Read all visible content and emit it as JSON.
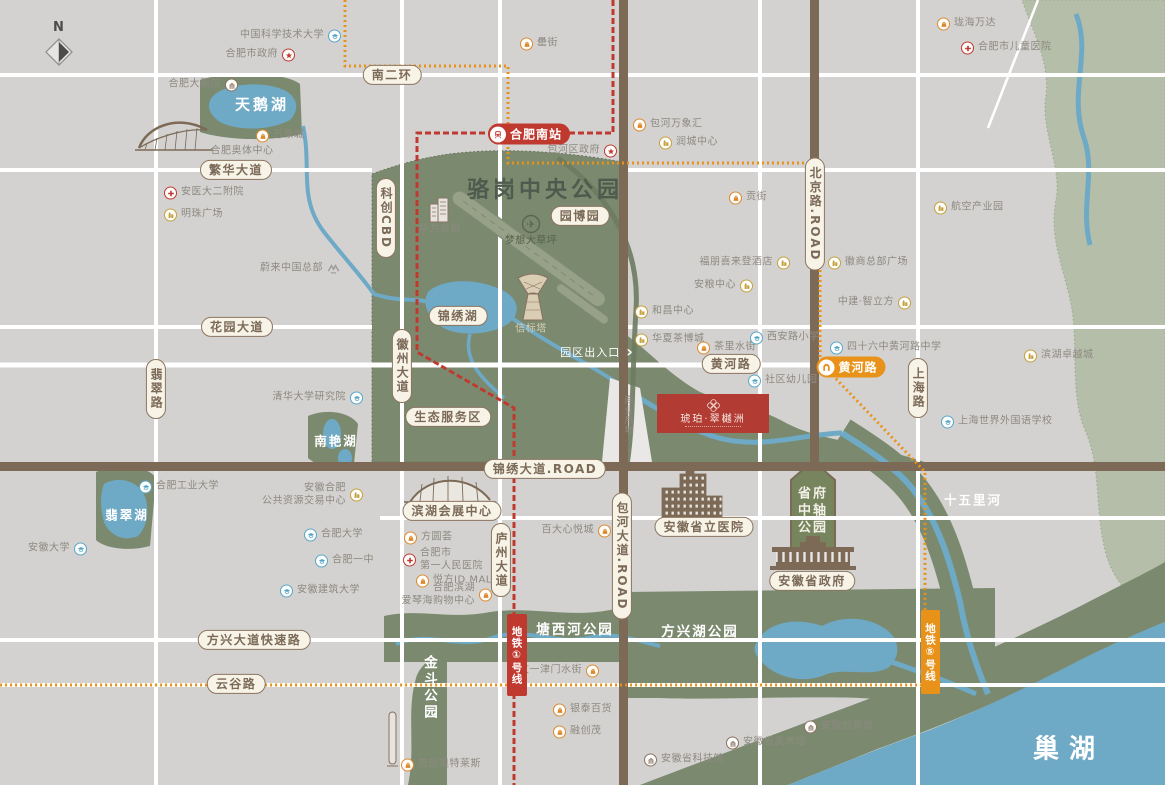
{
  "compass": {
    "label": "N"
  },
  "titles": {
    "park": "骆岗中央公园"
  },
  "project": {
    "name": "琥珀·翠樾洲"
  },
  "stations": {
    "hefei_south": "合肥南站",
    "huanghe_road": "黄河路"
  },
  "metro": {
    "line1": "地铁①号线",
    "line5": "地铁⑤号线"
  },
  "park_features": {
    "entrance": "园区出入口",
    "entrance_arrow": "›",
    "commercial": "商业用地",
    "axis_park": "省府\n中轴\n公园"
  },
  "road_labels": [
    {
      "t": "南二环",
      "x": 392,
      "y": 75
    },
    {
      "t": "繁华大道",
      "x": 236,
      "y": 170
    },
    {
      "t": "花园大道",
      "x": 237,
      "y": 327
    },
    {
      "t": "翡翠路",
      "x": 156,
      "y": 389,
      "v": true
    },
    {
      "t": "科创CBD",
      "x": 386,
      "y": 218,
      "v": true
    },
    {
      "t": "锦绣湖",
      "x": 458,
      "y": 316
    },
    {
      "t": "园博园",
      "x": 580,
      "y": 216
    },
    {
      "t": "徽州大道",
      "x": 402,
      "y": 366,
      "v": true
    },
    {
      "t": "黄河路",
      "x": 731,
      "y": 364
    },
    {
      "t": "生态服务区",
      "x": 448,
      "y": 417
    },
    {
      "t": "锦绣大道.ROAD",
      "x": 545,
      "y": 469
    },
    {
      "t": "滨湖会展中心",
      "x": 452,
      "y": 511
    },
    {
      "t": "庐州大道",
      "x": 501,
      "y": 560,
      "v": true
    },
    {
      "t": "包河大道.ROAD",
      "x": 622,
      "y": 556,
      "v": true
    },
    {
      "t": "北京路.ROAD",
      "x": 815,
      "y": 214,
      "v": true
    },
    {
      "t": "安徽省立医院",
      "x": 704,
      "y": 527
    },
    {
      "t": "安徽省政府",
      "x": 812,
      "y": 581
    },
    {
      "t": "上海路",
      "x": 918,
      "y": 388,
      "v": true
    },
    {
      "t": "方兴大道快速路",
      "x": 254,
      "y": 640
    },
    {
      "t": "云谷路",
      "x": 236,
      "y": 684
    }
  ],
  "area_labels": [
    {
      "t": "天鹅湖",
      "x": 262,
      "y": 104,
      "cls": "lake-lg"
    },
    {
      "t": "南艳湖",
      "x": 336,
      "y": 440,
      "cls": "lake"
    },
    {
      "t": "翡翠湖",
      "x": 127,
      "y": 514,
      "cls": "lake"
    },
    {
      "t": "十五里河",
      "x": 973,
      "y": 499,
      "cls": "lake"
    },
    {
      "t": "巢湖",
      "x": 1069,
      "y": 747,
      "cls": "lake-xl"
    },
    {
      "t": "塘西河公园",
      "x": 575,
      "y": 628,
      "cls": "parkband"
    },
    {
      "t": "方兴湖公园",
      "x": 700,
      "y": 630,
      "cls": "parkband"
    },
    {
      "t": "金斗公园",
      "x": 429,
      "y": 688,
      "cls": "parkband v"
    }
  ],
  "landmark_labels": [
    {
      "t": "合肥奥体中心",
      "x": 242,
      "y": 149,
      "cls": ""
    },
    {
      "t": "华为总部",
      "x": 440,
      "y": 227,
      "cls": ""
    },
    {
      "t": "梦想大草坪",
      "x": 531,
      "y": 239,
      "cls": "dark"
    },
    {
      "t": "信标塔",
      "x": 531,
      "y": 327,
      "cls": "beige"
    }
  ],
  "pois": [
    {
      "t": "中国科学技术大学",
      "x": 333,
      "y": 36,
      "icon": "school",
      "side": "left"
    },
    {
      "t": "合肥市政府",
      "x": 287,
      "y": 55,
      "icon": "gov",
      "side": "left"
    },
    {
      "t": "合肥大剧院",
      "x": 230,
      "y": 85,
      "icon": "culture",
      "side": "left"
    },
    {
      "t": "万象城",
      "x": 264,
      "y": 136,
      "icon": "mall",
      "side": "right"
    },
    {
      "t": "安医大二附院",
      "x": 172,
      "y": 193,
      "icon": "hospital",
      "side": "right"
    },
    {
      "t": "明珠广场",
      "x": 172,
      "y": 215,
      "icon": "building",
      "side": "right"
    },
    {
      "t": "罍街",
      "x": 528,
      "y": 44,
      "icon": "mall",
      "side": "right"
    },
    {
      "t": "包河万象汇",
      "x": 641,
      "y": 125,
      "icon": "mall",
      "side": "right"
    },
    {
      "t": "润城中心",
      "x": 667,
      "y": 143,
      "icon": "building",
      "side": "right"
    },
    {
      "t": "包河区政府",
      "x": 609,
      "y": 151,
      "icon": "gov",
      "side": "left"
    },
    {
      "t": "珑海万达",
      "x": 945,
      "y": 24,
      "icon": "mall",
      "side": "right"
    },
    {
      "t": "合肥市儿童医院",
      "x": 969,
      "y": 48,
      "icon": "hospital",
      "side": "right"
    },
    {
      "t": "贡街",
      "x": 737,
      "y": 198,
      "icon": "mall",
      "side": "right"
    },
    {
      "t": "航空产业园",
      "x": 942,
      "y": 208,
      "icon": "building",
      "side": "right"
    },
    {
      "t": "福朋喜来登酒店",
      "x": 782,
      "y": 263,
      "icon": "building",
      "side": "left"
    },
    {
      "t": "徽商总部广场",
      "x": 836,
      "y": 263,
      "icon": "building",
      "side": "right"
    },
    {
      "t": "安粮中心",
      "x": 745,
      "y": 286,
      "icon": "building",
      "side": "left"
    },
    {
      "t": "和昌中心",
      "x": 643,
      "y": 312,
      "icon": "building",
      "side": "right"
    },
    {
      "t": "中建·智立方",
      "x": 903,
      "y": 303,
      "icon": "building",
      "side": "left"
    },
    {
      "t": "华夏茶博城",
      "x": 643,
      "y": 340,
      "icon": "building",
      "side": "right"
    },
    {
      "t": "茶里水街",
      "x": 705,
      "y": 348,
      "icon": "mall",
      "side": "right"
    },
    {
      "t": "西安路小学",
      "x": 758,
      "y": 338,
      "icon": "school",
      "side": "right"
    },
    {
      "t": "四十六中黄河路中学",
      "x": 838,
      "y": 348,
      "icon": "school",
      "side": "right"
    },
    {
      "t": "社区幼儿园",
      "x": 756,
      "y": 381,
      "icon": "school",
      "side": "right"
    },
    {
      "t": "滨湖卓越城",
      "x": 1032,
      "y": 356,
      "icon": "building",
      "side": "right"
    },
    {
      "t": "上海世界外国语学校",
      "x": 949,
      "y": 422,
      "icon": "school",
      "side": "right"
    },
    {
      "t": "蔚来中国总部",
      "x": 332,
      "y": 269,
      "icon": "nio",
      "side": "left"
    },
    {
      "t": "清华大学研究院",
      "x": 355,
      "y": 398,
      "icon": "school",
      "side": "left"
    },
    {
      "t": "合肥工业大学",
      "x": 147,
      "y": 487,
      "icon": "school",
      "side": "right"
    },
    {
      "t": "安徽大学",
      "x": 79,
      "y": 549,
      "icon": "school",
      "side": "left"
    },
    {
      "t": "安徽合肥\n公共资源交易中心",
      "x": 355,
      "y": 495,
      "icon": "building",
      "side": "left"
    },
    {
      "t": "合肥大学",
      "x": 312,
      "y": 535,
      "icon": "school",
      "side": "right"
    },
    {
      "t": "合肥一中",
      "x": 323,
      "y": 561,
      "icon": "school",
      "side": "right"
    },
    {
      "t": "安徽建筑大学",
      "x": 288,
      "y": 591,
      "icon": "school",
      "side": "right"
    },
    {
      "t": "方圆荟",
      "x": 412,
      "y": 538,
      "icon": "mall",
      "side": "right"
    },
    {
      "t": "合肥市\n第一人民医院",
      "x": 411,
      "y": 560,
      "icon": "hospital",
      "side": "right"
    },
    {
      "t": "悦方ID MALL",
      "x": 424,
      "y": 581,
      "icon": "mall",
      "side": "right"
    },
    {
      "t": "百大心悦城",
      "x": 603,
      "y": 531,
      "icon": "mall",
      "side": "left"
    },
    {
      "t": "合肥滨湖\n爱琴海购物中心",
      "x": 484,
      "y": 595,
      "icon": "mall",
      "side": "left"
    },
    {
      "t": "文一津门水街",
      "x": 591,
      "y": 671,
      "icon": "mall",
      "side": "left"
    },
    {
      "t": "银泰百货",
      "x": 561,
      "y": 710,
      "icon": "mall",
      "side": "right"
    },
    {
      "t": "融创茂",
      "x": 561,
      "y": 732,
      "icon": "mall",
      "side": "right"
    },
    {
      "t": "安徽省科技馆",
      "x": 652,
      "y": 760,
      "icon": "culture",
      "side": "right"
    },
    {
      "t": "安徽创新馆",
      "x": 812,
      "y": 727,
      "icon": "culture",
      "side": "right"
    },
    {
      "t": "安徽省美术馆",
      "x": 734,
      "y": 743,
      "icon": "culture",
      "side": "right"
    },
    {
      "t": "首创奥特莱斯",
      "x": 409,
      "y": 765,
      "icon": "mall",
      "side": "right"
    }
  ],
  "colors": {
    "background": "#d3d2d0",
    "park_green": "#7b8a6f",
    "sage_green": "#b5bea9",
    "water_blue": "#6ea9c6",
    "road_brown": "#7c6a56",
    "metro1_red": "#c0392f",
    "metro5_orange": "#e8921a",
    "capsule_cream": "#f8f3e7",
    "project_red": "#b23b33"
  }
}
